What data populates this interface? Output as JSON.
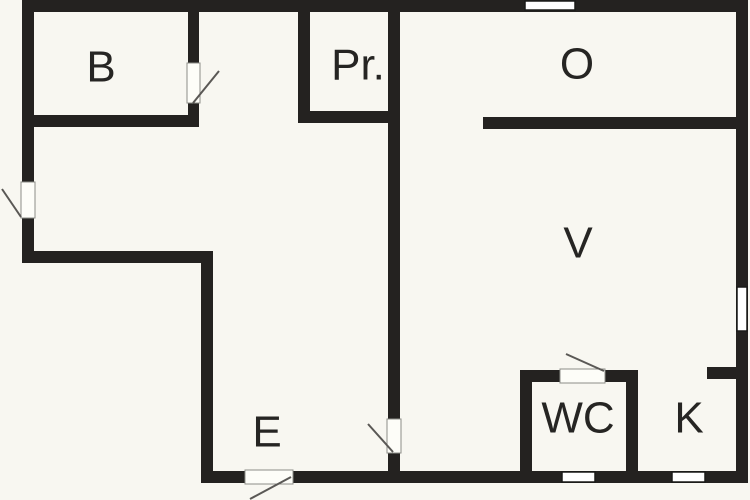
{
  "palette": {
    "background": "#f8f7f1",
    "wall": "#242220",
    "label_text": "#262523",
    "window_fill": "#ffffff",
    "window_stroke": "#1a1a18",
    "door_fill": "#fdfdf8",
    "door_stroke": "#8d8d88",
    "swing_line": "#5a5855"
  },
  "floor_plan": {
    "canvas": {
      "width": 750,
      "height": 500
    },
    "label_font_size": 44,
    "rooms": [
      {
        "id": "bedroom",
        "label": "B",
        "x": 101,
        "y": 67
      },
      {
        "id": "closet",
        "label": "Pr.",
        "x": 358,
        "y": 65
      },
      {
        "id": "room-o",
        "label": "O",
        "x": 577,
        "y": 64
      },
      {
        "id": "room-v",
        "label": "V",
        "x": 578,
        "y": 243
      },
      {
        "id": "entry",
        "label": "E",
        "x": 267,
        "y": 432
      },
      {
        "id": "wc",
        "label": "WC",
        "x": 578,
        "y": 418
      },
      {
        "id": "kitchen",
        "label": "K",
        "x": 689,
        "y": 418
      }
    ],
    "walls": [
      {
        "name": "outer-top-wall",
        "x": 22,
        "y": 0,
        "w": 726,
        "h": 12
      },
      {
        "name": "outer-left-wall",
        "x": 22,
        "y": 0,
        "w": 12,
        "h": 263
      },
      {
        "name": "notch-horizontal-wall",
        "x": 22,
        "y": 251,
        "w": 191,
        "h": 12
      },
      {
        "name": "notch-vertical-wall",
        "x": 201,
        "y": 251,
        "w": 12,
        "h": 232
      },
      {
        "name": "outer-bottom-wall",
        "x": 201,
        "y": 471,
        "w": 547,
        "h": 12
      },
      {
        "name": "outer-right-wall",
        "x": 736,
        "y": 0,
        "w": 12,
        "h": 483
      },
      {
        "name": "bedroom-bottom-wall",
        "x": 28,
        "y": 115,
        "w": 171,
        "h": 12
      },
      {
        "name": "bedroom-right-wall-upper",
        "x": 188,
        "y": 0,
        "w": 11,
        "h": 64
      },
      {
        "name": "bedroom-right-wall-lower",
        "x": 188,
        "y": 102,
        "w": 11,
        "h": 25
      },
      {
        "name": "closet-left-wall",
        "x": 298,
        "y": 6,
        "w": 12,
        "h": 117
      },
      {
        "name": "closet-bottom-wall",
        "x": 298,
        "y": 111,
        "w": 102,
        "h": 12
      },
      {
        "name": "main-vertical-wall-upper",
        "x": 388,
        "y": 0,
        "w": 12,
        "h": 420
      },
      {
        "name": "main-vertical-wall-lower",
        "x": 388,
        "y": 452,
        "w": 12,
        "h": 31
      },
      {
        "name": "room-o-bottom-wall",
        "x": 483,
        "y": 117,
        "w": 265,
        "h": 12
      },
      {
        "name": "wc-left-wall",
        "x": 520,
        "y": 370,
        "w": 12,
        "h": 107
      },
      {
        "name": "wc-top-wall-left",
        "x": 520,
        "y": 370,
        "w": 42,
        "h": 12
      },
      {
        "name": "wc-top-wall-right",
        "x": 603,
        "y": 370,
        "w": 35,
        "h": 12
      },
      {
        "name": "wc-right-wall",
        "x": 626,
        "y": 370,
        "w": 12,
        "h": 107
      },
      {
        "name": "kitchen-stub-wall",
        "x": 707,
        "y": 367,
        "w": 30,
        "h": 12
      }
    ],
    "windows": [
      {
        "name": "window-top-wall",
        "x": 525,
        "y": 1,
        "w": 50,
        "h": 9
      },
      {
        "name": "window-right-wall",
        "x": 737,
        "y": 287,
        "w": 10,
        "h": 44
      },
      {
        "name": "window-bottom-wall-wc",
        "x": 562,
        "y": 472,
        "w": 33,
        "h": 10
      },
      {
        "name": "window-bottom-wall-k",
        "x": 672,
        "y": 472,
        "w": 33,
        "h": 10
      }
    ],
    "door_openings": [
      {
        "name": "bedroom-door-opening",
        "x": 187,
        "y": 63,
        "w": 13,
        "h": 40
      },
      {
        "name": "balcony-door-opening",
        "x": 21,
        "y": 182,
        "w": 14,
        "h": 36
      },
      {
        "name": "hall-door-opening",
        "x": 387,
        "y": 419,
        "w": 14,
        "h": 34
      },
      {
        "name": "entry-door-opening",
        "x": 245,
        "y": 470,
        "w": 48,
        "h": 14
      },
      {
        "name": "wc-door-opening",
        "x": 560,
        "y": 369,
        "w": 45,
        "h": 14
      }
    ],
    "door_swings": [
      {
        "name": "bedroom-door-swing",
        "x1": 193,
        "y1": 103,
        "x2": 219,
        "y2": 71
      },
      {
        "name": "balcony-door-swing",
        "x1": 2,
        "y1": 189,
        "x2": 21,
        "y2": 217
      },
      {
        "name": "hall-door-swing",
        "x1": 368,
        "y1": 424,
        "x2": 393,
        "y2": 452
      },
      {
        "name": "entry-door-swing",
        "x1": 291,
        "y1": 477,
        "x2": 250,
        "y2": 499
      },
      {
        "name": "wc-door-swing",
        "x1": 566,
        "y1": 354,
        "x2": 604,
        "y2": 371
      }
    ]
  }
}
